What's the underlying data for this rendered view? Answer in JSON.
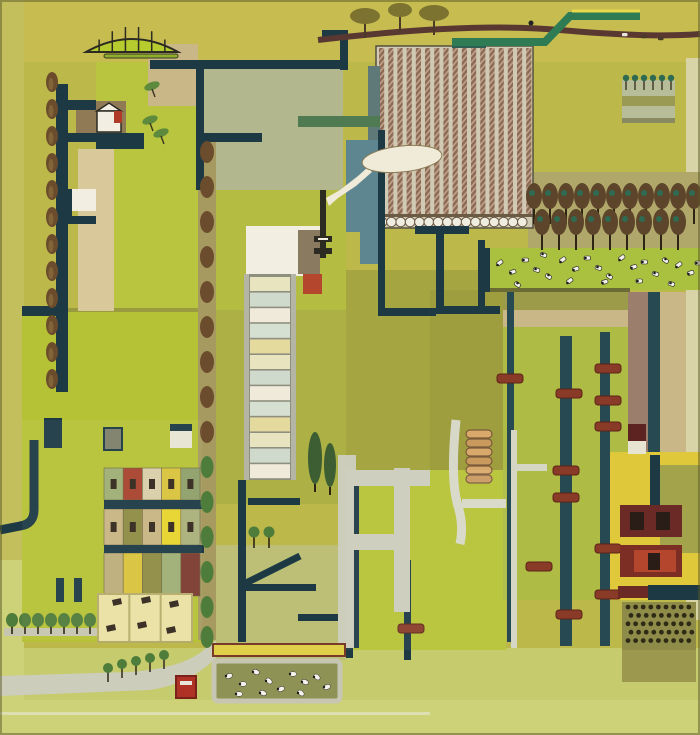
{
  "artwork": {
    "kind": "painting",
    "subject": "aerial-view patchwork farmland: fields, navy roads, striped crop field, greenhouse strip, orchards, cow pasture, sheep pen, village houses, railway-like tracks with red ties",
    "text_content": "none"
  },
  "palette": {
    "bgMain": "#bdb84a",
    "bgTop": "#c7bc50",
    "bgLeft": "#c2bf5c",
    "bgBright": "#b6c235",
    "bgPale": "#cdd178",
    "bgPaleBottom": "#c6cb6d",
    "creamEdge": "#d9d4a8",
    "sage": "#b2b78e",
    "upperGreen": "#b9c53e",
    "centerField": "#adb044",
    "centerFieldTop": "#b4bc42",
    "oliveField": "#a5a642",
    "oliveDark": "#9f9e3e",
    "rightField": "#aebb44",
    "oliveBand": "#9c9b4a",
    "paleCenter": "#bcbf75",
    "navy": "#1c3944",
    "navy2": "#274a52",
    "teal": "#5d8691",
    "slate": "#5f7878",
    "tealDash": "#2e5f52",
    "white": "#f2efe2",
    "cream": "#e8e4d2",
    "tan": "#c9b788",
    "tanPale": "#d9c99a",
    "brownPlot": "#8f7a55",
    "maroon": "#6b2a26",
    "maroonDark": "#5d2320",
    "red": "#b03a28",
    "redBright": "#b5462e",
    "brickRed": "#8a3b28",
    "roadBrown": "#5a3832",
    "stripeBrown": "#8d6a55",
    "stripeHatch": "#c8ab92",
    "stripeBase": "#d0cab5",
    "scallop": "#efece0",
    "outlineDark": "#55503e",
    "treeOlive": "#7c7330",
    "treeBrown": "#6b4c2c",
    "treeGreen": "#4e7c3a",
    "cypress": "#3c5e32",
    "orchardBrown": "#5c452a",
    "orchardTeal": "#2f6b52",
    "orchardBand": "#b0a86a",
    "grayRoad": "#cdcdbb",
    "grayPath": "#c6c6b0",
    "yellow": "#dfc93a",
    "yellowStrip": "#e0d049",
    "yellowPale": "#eae1a4",
    "mauve": "#9b7e6c",
    "greenRoad": "#2f7b53",
    "yellowEdge": "#e8d84b",
    "smoke": "#f0ebd8",
    "penOlive": "#8e9355",
    "penBorder": "#c6c6b2",
    "dotDark": "#2e2a16",
    "windowDark": "#32281c",
    "pasture": "#a9c13f",
    "awning": "#b6cc2e",
    "estateOlive": "#a3a34c",
    "speckleBase": "#8f8c4a",
    "speckleBase2": "#9c994e",
    "inkDark": "#2b2b22",
    "frameGray": "#8f8f80",
    "railGray": "#b5b5a6",
    "hutGray": "#7d7f6a",
    "vanRed": "#b03226"
  },
  "scene": {
    "awning": {
      "x": 86,
      "y": 52,
      "w": 92,
      "rise": 26,
      "ribs": 7
    },
    "top_road": {
      "from_x": 318,
      "to_x": 700
    },
    "top_tree_blobs": [
      [
        365,
        16,
        15,
        8
      ],
      [
        400,
        10,
        12,
        7
      ],
      [
        434,
        13,
        15,
        8
      ]
    ],
    "top_figure": [
      531,
      23
    ],
    "top_vehicles": [
      [
        622,
        33
      ],
      [
        641,
        35
      ],
      [
        658,
        37
      ]
    ],
    "green_s_road": {
      "seg1": [
        452,
        42,
        545,
        42
      ],
      "diag": [
        545,
        42,
        570,
        16
      ],
      "seg2": [
        570,
        16,
        640,
        16
      ],
      "lower_band": [
        298,
        116,
        82,
        11
      ]
    },
    "mini_orchard_trees": {
      "xs": [
        626,
        635,
        644,
        653,
        662,
        671
      ],
      "y": 78
    },
    "striped_field": {
      "x": 376,
      "y": 46,
      "w": 157,
      "h": 182,
      "stripes": 17,
      "stripe_w": 5.2,
      "step": 9.2,
      "scallops": 16
    },
    "cloud": {
      "cx": 402,
      "cy": 159,
      "rx": 40,
      "ry": 13
    },
    "chimney": {
      "x": 320,
      "y": 190,
      "h": 68
    },
    "greenhouse": {
      "x": 244,
      "y": 274,
      "w": 52,
      "h": 206,
      "bands": 13,
      "band_colors": [
        "#e9e4c0",
        "#cfdacd",
        "#f0eadb",
        "#d6e0d2",
        "#e4da9e"
      ]
    },
    "cypresses": [
      [
        315,
        458,
        7,
        26
      ],
      [
        330,
        465,
        6,
        22
      ]
    ],
    "poplars": {
      "x": 52,
      "ys": [
        82,
        109,
        136,
        163,
        190,
        217,
        244,
        271,
        298,
        325,
        352,
        379
      ]
    },
    "tree_road": {
      "x": 207,
      "ys": [
        152,
        187,
        222,
        257,
        292,
        327,
        362,
        397,
        432
      ],
      "green_ys": [
        467,
        502,
        537,
        572,
        607,
        637
      ]
    },
    "orchard_row1": {
      "y": 196,
      "xs": [
        534,
        550,
        566,
        582,
        598,
        614,
        630,
        646,
        662,
        678,
        694
      ]
    },
    "orchard_row2": {
      "y": 222,
      "xs": [
        542,
        559,
        576,
        593,
        610,
        627,
        644,
        661,
        678
      ]
    },
    "cows": [
      [
        496,
        263
      ],
      [
        509,
        271
      ],
      [
        522,
        258
      ],
      [
        534,
        267
      ],
      [
        547,
        273
      ],
      [
        559,
        260
      ],
      [
        572,
        268
      ],
      [
        584,
        256
      ],
      [
        596,
        265
      ],
      [
        608,
        273
      ],
      [
        618,
        258
      ],
      [
        630,
        266
      ],
      [
        641,
        260
      ],
      [
        653,
        271
      ],
      [
        664,
        257
      ],
      [
        675,
        265
      ],
      [
        687,
        272
      ],
      [
        695,
        261
      ],
      [
        541,
        252
      ],
      [
        516,
        281
      ],
      [
        566,
        281
      ],
      [
        601,
        281
      ],
      [
        636,
        279
      ],
      [
        669,
        281
      ]
    ],
    "sheep": [
      [
        229,
        676
      ],
      [
        243,
        684
      ],
      [
        256,
        672
      ],
      [
        269,
        681
      ],
      [
        281,
        689
      ],
      [
        293,
        674
      ],
      [
        305,
        682
      ],
      [
        317,
        677
      ],
      [
        327,
        687
      ],
      [
        239,
        694
      ],
      [
        263,
        693
      ],
      [
        301,
        693
      ]
    ],
    "railway_ties": [
      [
        497,
        374
      ],
      [
        556,
        389
      ],
      [
        595,
        364
      ],
      [
        595,
        396
      ],
      [
        595,
        422
      ],
      [
        553,
        466
      ],
      [
        553,
        493
      ],
      [
        526,
        562
      ],
      [
        595,
        544
      ],
      [
        595,
        590
      ],
      [
        556,
        610
      ],
      [
        398,
        624
      ]
    ],
    "village": {
      "x": 104,
      "facade_w": 19.2,
      "rows": [
        {
          "y": 468,
          "h": 32,
          "colors": [
            "#9fae74",
            "#a8432e",
            "#d8cfa8",
            "#d9c23b",
            "#8fa06a"
          ],
          "windows": true
        },
        {
          "y": 509,
          "h": 36,
          "colors": [
            "#c9b583",
            "#8f8c44",
            "#c9b583",
            "#e6d42c",
            "#a9b07a"
          ],
          "windows": true
        },
        {
          "y": 553,
          "h": 43,
          "colors": [
            "#bcae7a",
            "#d9c23b",
            "#8f8c44",
            "#9fae74",
            "#7c3a2e"
          ],
          "windows": false
        }
      ]
    },
    "allotment": {
      "x": 98,
      "y": 594,
      "w": 94,
      "h": 48,
      "sheds": [
        [
          112,
          600
        ],
        [
          106,
          626
        ],
        [
          141,
          598
        ],
        [
          137,
          623
        ],
        [
          169,
          602
        ],
        [
          166,
          628
        ]
      ]
    },
    "speckle_plot": {
      "x": 628,
      "y": 607,
      "rows": 5,
      "cols": 9,
      "dx": 7.6,
      "dy": 8.4
    },
    "bottom_left_trees": {
      "xs": [
        12,
        25,
        38,
        51,
        64,
        77,
        90
      ],
      "y": 620
    },
    "road_trees": [
      [
        108,
        668
      ],
      [
        122,
        664
      ],
      [
        136,
        661
      ],
      [
        150,
        658
      ],
      [
        164,
        655
      ]
    ],
    "field_trees": [
      [
        254,
        532
      ],
      [
        269,
        532
      ]
    ],
    "sprigs": [
      [
        152,
        86
      ],
      [
        150,
        120
      ],
      [
        161,
        133
      ]
    ],
    "caterpillar": {
      "x": 466,
      "y": 430,
      "segments": 6
    },
    "counts": {
      "cows": 24,
      "sheep": 12,
      "poplars": 12,
      "orchard_trees": 20,
      "field_stripes": 17
    }
  }
}
